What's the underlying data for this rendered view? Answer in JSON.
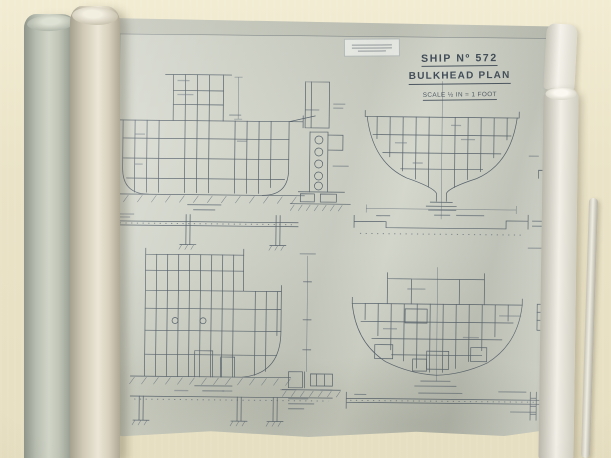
{
  "title_block": {
    "ship_no": "SHIP Nº 572",
    "drawing_title": "BULKHEAD PLAN",
    "scale": "SCALE ½ IN = 1 FOOT"
  },
  "colors": {
    "table_surface": "#eae3c7",
    "paper_sheet": "#d2d5ca",
    "ink": "#56616c",
    "roll_green": "#b7bdb0",
    "roll_cream": "#dfd9c7",
    "roll_white": "#f1efe6"
  }
}
